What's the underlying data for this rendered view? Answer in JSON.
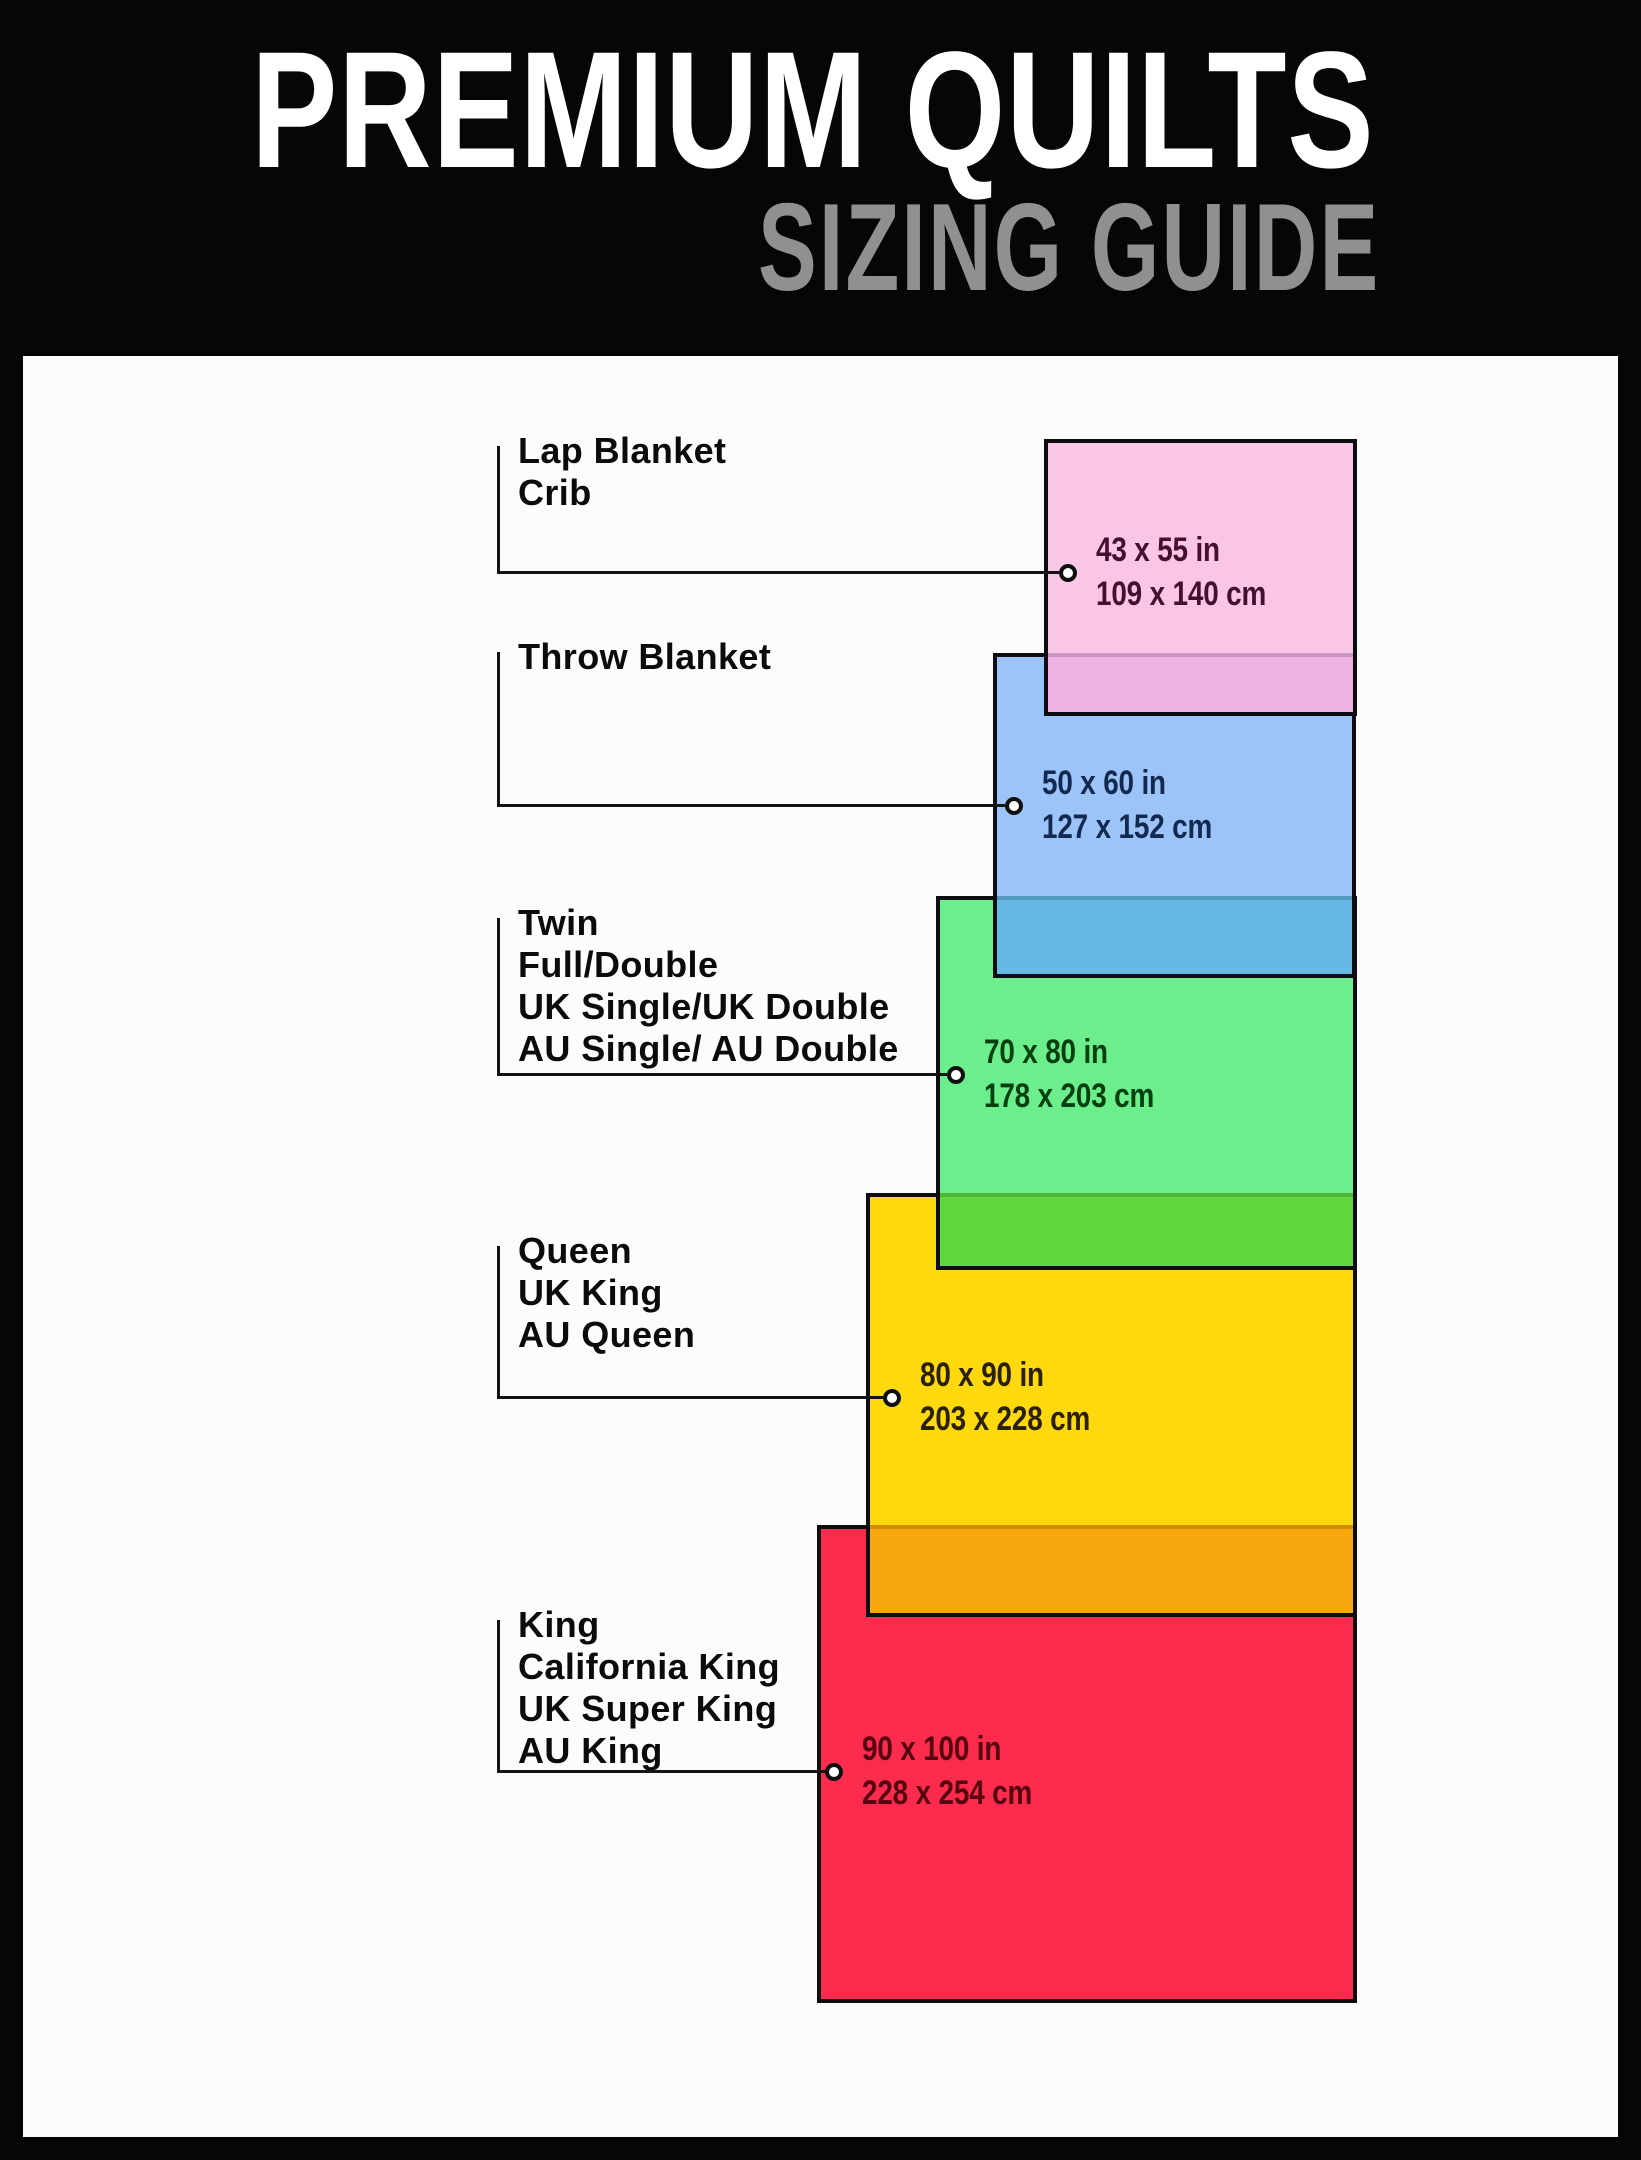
{
  "header": {
    "title": "PREMIUM QUILTS",
    "subtitle": "SIZING GUIDE"
  },
  "frame_color": "#060606",
  "panel_color": "#fcfcfc",
  "sizes": [
    {
      "slug": "lap-blanket-crib",
      "labels": [
        "Lap Blanket",
        "Crib"
      ],
      "dimensions_in": "43 x 55 in",
      "dimensions_cm": "109 x 140 cm",
      "fill": "#f9c7e5",
      "overlap_fill": "#eeb2e2",
      "text_color": "#43112f",
      "rect": {
        "left": 1044,
        "top": 439,
        "width": 313,
        "height": 277,
        "overlap": 63
      },
      "label_top": 430,
      "line_y": 573,
      "dot_x": 1068
    },
    {
      "slug": "throw-blanket",
      "labels": [
        "Throw Blanket"
      ],
      "dimensions_in": "50 x 60 in",
      "dimensions_cm": "127 x 152 cm",
      "fill": "#9dc4f8",
      "overlap_fill": "#65b9e4",
      "text_color": "#132a50",
      "rect": {
        "left": 993,
        "top": 653,
        "width": 363,
        "height": 325,
        "overlap": 82
      },
      "label_top": 636,
      "line_y": 806,
      "dot_x": 1014
    },
    {
      "slug": "twin-full-double",
      "labels": [
        "Twin",
        "Full/Double",
        "UK Single/UK Double",
        "AU Single/ AU Double"
      ],
      "dimensions_in": "70 x 80 in",
      "dimensions_cm": "178 x 203 cm",
      "fill": "#6cee8d",
      "overlap_fill": "#5fd83e",
      "text_color": "#06400f",
      "rect": {
        "left": 936,
        "top": 896,
        "width": 421,
        "height": 374,
        "overlap": 77
      },
      "label_top": 902,
      "line_y": 1075,
      "dot_x": 956
    },
    {
      "slug": "queen",
      "labels": [
        "Queen",
        "UK King",
        "AU Queen"
      ],
      "dimensions_in": "80 x 90 in",
      "dimensions_cm": "203 x 228 cm",
      "fill": "#fdd90d",
      "overlap_fill": "#f8a70e",
      "text_color": "#2b2002",
      "rect": {
        "left": 866,
        "top": 1193,
        "width": 491,
        "height": 424,
        "overlap": 92
      },
      "label_top": 1230,
      "line_y": 1398,
      "dot_x": 892
    },
    {
      "slug": "king",
      "labels": [
        "King",
        "California King",
        "UK Super King",
        "AU King"
      ],
      "dimensions_in": "90 x 100 in",
      "dimensions_cm": "228 x 254 cm",
      "fill": "#fb2b4e",
      "overlap_fill": null,
      "text_color": "#55050f",
      "rect": {
        "left": 817,
        "top": 1525,
        "width": 540,
        "height": 478,
        "overlap": 0
      },
      "label_top": 1604,
      "line_y": 1772,
      "dot_x": 834
    }
  ]
}
